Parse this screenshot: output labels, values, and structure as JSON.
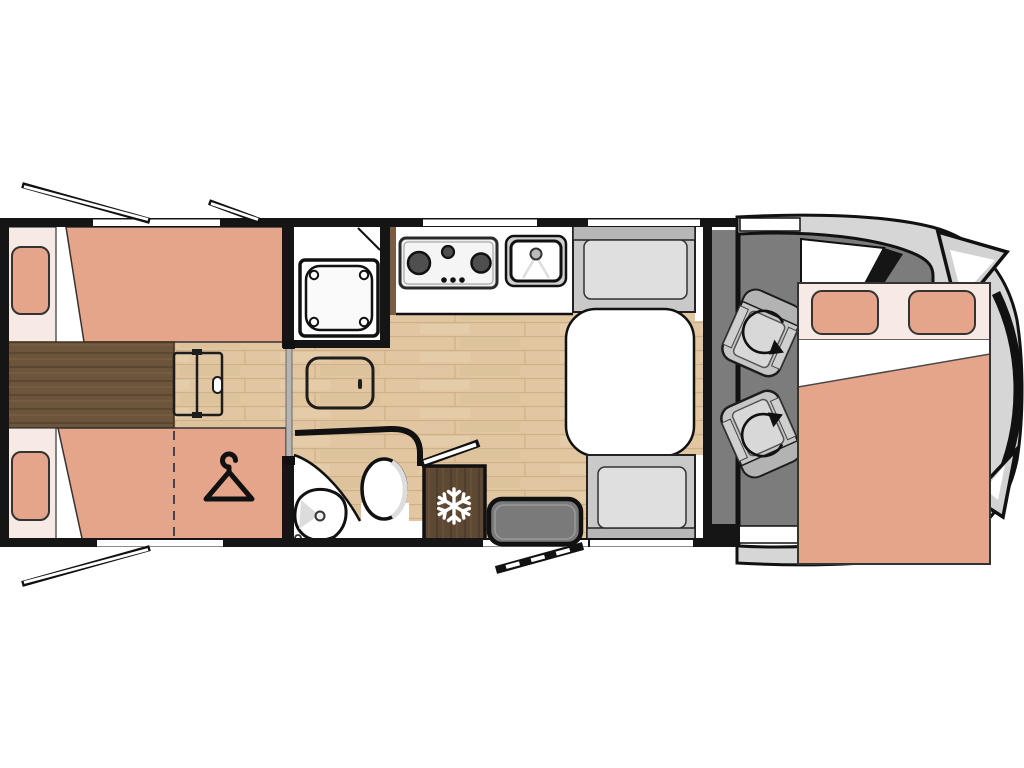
{
  "plan": {
    "type": "motorhome-floor-plan",
    "areas": [
      "rear-twin-beds",
      "under-bed-wardrobe",
      "bed-ladder",
      "sliding-door",
      "shower-cabin",
      "vanity-cabinet",
      "bathroom",
      "washbasin",
      "toilet",
      "kitchen-counter",
      "hob",
      "kitchen-sink",
      "dinette-table",
      "bench-seat-front",
      "bench-seat-rear",
      "fridge-freezer",
      "entry-step",
      "entry-door",
      "cab",
      "swivel-seat-driver",
      "swivel-seat-passenger",
      "drop-down-double-bed",
      "vehicle-front"
    ]
  },
  "icons": {
    "hanger-icon": "wardrobe storage under bed",
    "snowflake-icon": "fridge-freezer",
    "rotation-arrow-icon": "swivelling cab seat",
    "open-window-line": "opening window",
    "open-door-bar": "entrance door open"
  },
  "colors": {
    "wall": "#151515",
    "floor": "#e1c6a1",
    "floor_line": "#cdb189",
    "dark_wood": "#6d553b",
    "dark_wood_line": "#57442e",
    "fridge_wood": "#5d4833",
    "mattress": "#e4a58a",
    "linen": "#f7e9e3",
    "white": "#ffffff",
    "bench": "#c9c9c9",
    "bench_back": "#b7b7b7",
    "cushion": "#dfdfdf",
    "cab_floor": "#7c7c7c",
    "body": "#d6d6d6",
    "seat": "#c6c6c6",
    "seat_pad": "#d8d8d8",
    "step": "#7a7a7a",
    "slider": "#b5b5b5",
    "hob_face": "#ededed",
    "burner": "#4f4f4f",
    "steel": "#cfcfcf",
    "tray": "#fafafa"
  }
}
